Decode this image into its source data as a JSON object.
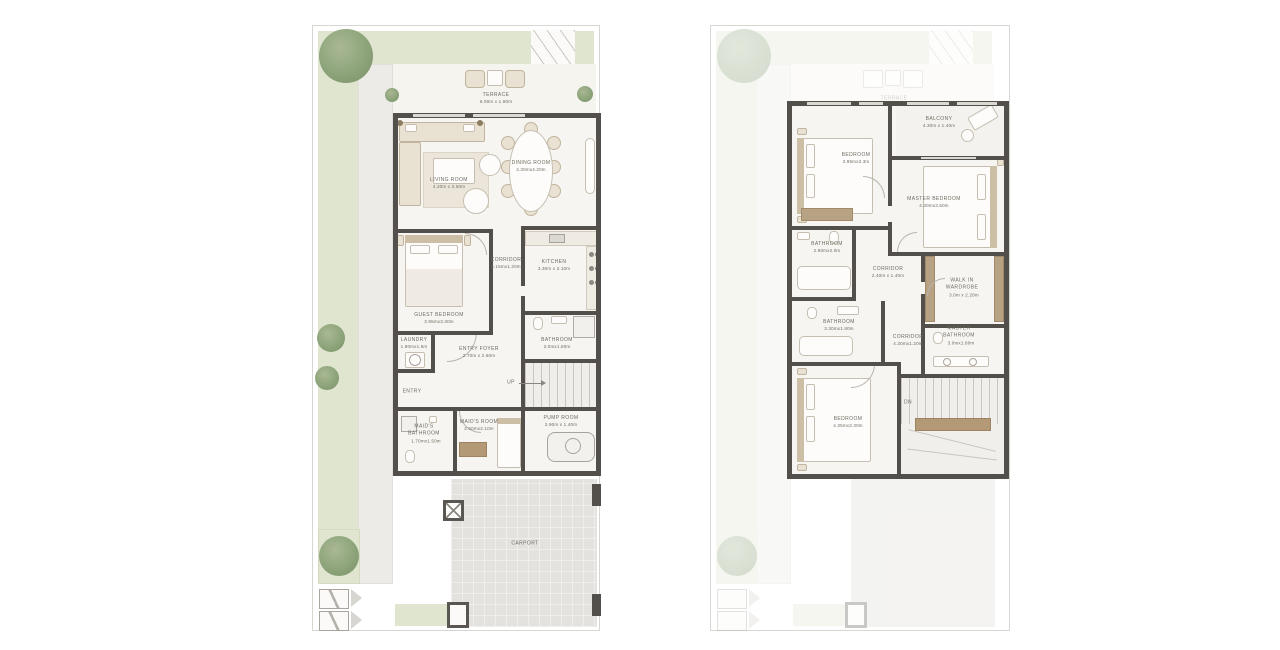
{
  "colors": {
    "wall": "#53504b",
    "garden": "#dfe5cf",
    "tree": "#8da47b",
    "floor": "#f7f5f1",
    "wood": "#b39976",
    "carport": "#e4e2df",
    "label": "#6f6b62"
  },
  "ground_floor": {
    "terrace": {
      "name": "TERRACE",
      "dims": "6.00m x 1.80m"
    },
    "living_room": {
      "name": "LIVING ROOM",
      "dims": "4.20m x 3.50m"
    },
    "dining_room": {
      "name": "DINING ROOM",
      "dims": "4.30mx4.20m"
    },
    "corridor": {
      "name": "CORRIDOR",
      "dims": "4.15mx1.20m"
    },
    "kitchen": {
      "name": "KITCHEN",
      "dims": "3.30m x 3.10m"
    },
    "guest_bedroom": {
      "name": "GUEST BEDROOM",
      "dims": "3.95mx3.30m"
    },
    "laundry": {
      "name": "LAUNDRY",
      "dims": "1.90mx1.6m"
    },
    "entry_foyer": {
      "name": "ENTRY FOYER",
      "dims": "2.70m x 2.60m"
    },
    "bathroom": {
      "name": "BATHROOM",
      "dims": "3.0mx1.80m"
    },
    "entry": {
      "name": "ENTRY"
    },
    "up": {
      "name": "UP"
    },
    "maids_bathroom": {
      "name": "MAID'S BATHROOM",
      "dims": "1.70mx1.50m"
    },
    "maids_room": {
      "name": "MAID'S ROOM",
      "dims": "2.60mx2.10m"
    },
    "pump_room": {
      "name": "PUMP ROOM",
      "dims": "2.90m x 1.40m"
    },
    "carport": {
      "name": "CARPORT"
    }
  },
  "first_floor": {
    "terrace_below": {
      "name": "TERRACE"
    },
    "bedroom_1": {
      "name": "BEDROOM",
      "dims": "3.95mx3.3m"
    },
    "balcony": {
      "name": "BALCONY",
      "dims": "4.30m x 1.40m"
    },
    "master_bedroom": {
      "name": "MASTER BEDROOM",
      "dims": "4.30mx3.60m"
    },
    "bathroom_1": {
      "name": "BATHROOM",
      "dims": "2.80mx2.0m"
    },
    "corridor_1": {
      "name": "CORRIDOR",
      "dims": "2.40m x 1.40m"
    },
    "walk_in_wardrobe": {
      "name": "WALK IN WARDROBE",
      "dims": "3.0m x 2.20m"
    },
    "bathroom_2": {
      "name": "BATHROOM",
      "dims": "3.30mx1.80m"
    },
    "corridor_2": {
      "name": "CORRIDOR",
      "dims": "4.30mx1.20m"
    },
    "master_bathroom": {
      "name": "MASTER BATHROOM",
      "dims": "3.0mx1.80m"
    },
    "bedroom_2": {
      "name": "BEDROOM",
      "dims": "4.35mx3.30m"
    },
    "down": {
      "name": "DN"
    }
  }
}
